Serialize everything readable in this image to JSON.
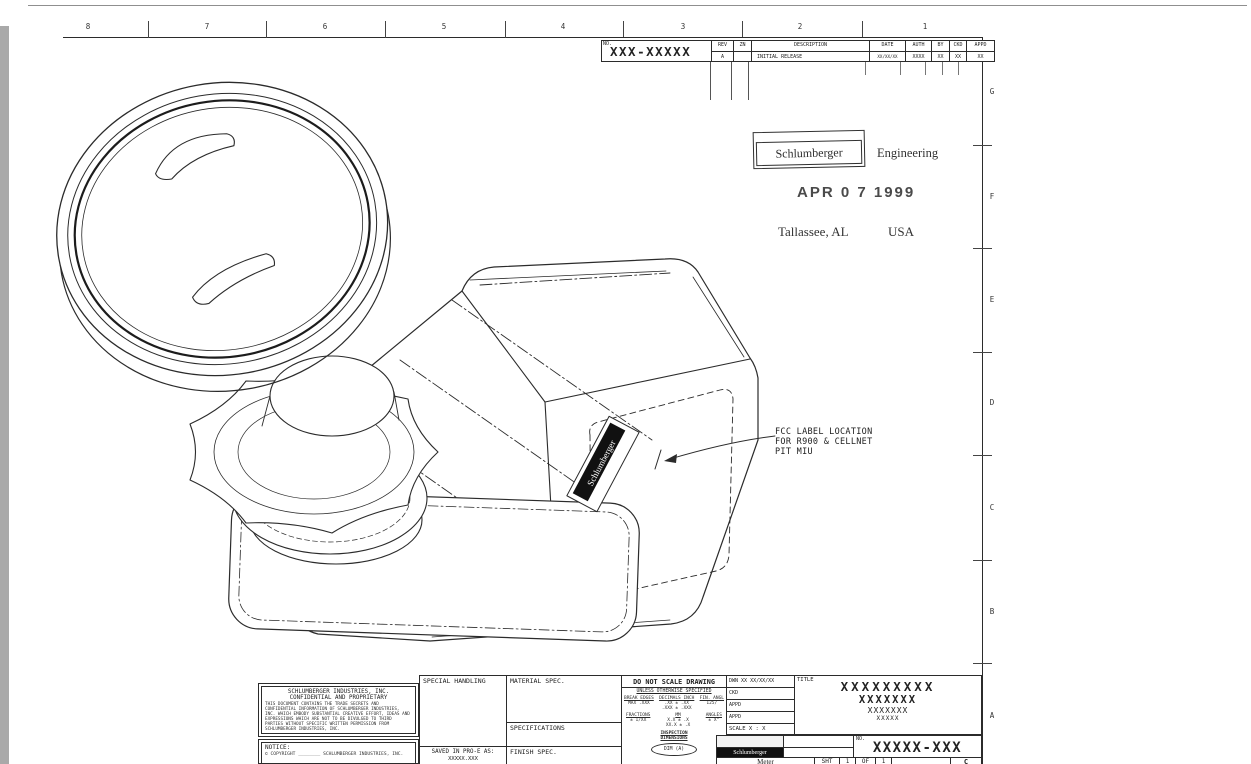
{
  "colors": {
    "ink": "#2b2b2b",
    "paper": "#ffffff",
    "scan_strip": "#a9a9a9",
    "label_bar": "#111111"
  },
  "zones": {
    "top": [
      "8",
      "7",
      "6",
      "5",
      "4",
      "3",
      "2",
      "1"
    ],
    "right": [
      "G",
      "F",
      "E",
      "D",
      "C",
      "B",
      "A"
    ]
  },
  "rev_table": {
    "no_label": "NO.",
    "number": "XXX-XXXXX",
    "col_rev": "REV",
    "col_zn": "ZN",
    "col_desc": "DESCRIPTION",
    "col_date": "DATE",
    "col_auth": "AUTH",
    "col_by": "BY",
    "col_ckd": "CKD",
    "col_appd": "APPD",
    "rev": "A",
    "zn": "",
    "desc": "INITIAL RELEASE",
    "date": "XX/XX/XX",
    "auth": "XXXX",
    "by": "XX",
    "ckd": "XX",
    "appd": "XX"
  },
  "stamp": {
    "logo": "Schlumberger",
    "org": "Engineering",
    "date": "APR 0 7 1999",
    "city": "Tallassee, AL",
    "country": "USA"
  },
  "fcc_note": {
    "line1": "FCC LABEL LOCATION",
    "line2": "FOR R900 & CELLNET",
    "line3": "PIT MIU"
  },
  "device": {
    "label": "Schlumberger"
  },
  "title_block": {
    "confidential": {
      "company": "SCHLUMBERGER INDUSTRIES, INC.",
      "subtitle": "CONFIDENTIAL AND PROPRIETARY",
      "body": "THIS DOCUMENT CONTAINS THE TRADE SECRETS AND CONFIDENTIAL INFORMATION OF SCHLUMBERGER INDUSTRIES, INC. WHICH EMBODY SUBSTANTIAL CREATIVE EFFORT, IDEAS AND EXPRESSIONS WHICH ARE NOT TO BE DIVULGED TO THIRD PARTIES WITHOUT SPECIFIC WRITTEN PERMISSION FROM SCHLUMBERGER INDUSTRIES, INC."
    },
    "notice": {
      "label": "NOTICE:",
      "copyright": "© COPYRIGHT ________  SCHLUMBERGER INDUSTRIES, INC."
    },
    "special_handling": "SPECIAL HANDLING",
    "saved_label": "SAVED IN PRO-E AS:",
    "saved_value": "XXXXX.XXX",
    "material": "MATERIAL SPEC.",
    "specifications": "SPECIFICATIONS",
    "finish": "FINISH SPEC.",
    "do_not_scale": "DO NOT SCALE DRAWING",
    "unless": "UNLESS OTHERWISE SPECIFIED",
    "tol": {
      "break1": "BREAK EDGES",
      "break2": "MAX .XXX",
      "dec_t": "DECIMALS INCH",
      "dec1": ".XX ± .XX",
      "dec2": ".XXX ± .XXX",
      "fin1": "FIN. ANGL",
      "fin2": "125/",
      "frac1": "FRACTIONS",
      "frac2": "± 1/XX",
      "mm_t": "MM",
      "mm1": "X.X ± .X",
      "mm2": "XX.X ± .X",
      "ang1": "ANGLES",
      "ang2": "± X°"
    },
    "inspection1": "INSPECTION",
    "inspection2": "DIMENSIONS",
    "dim_tag": "DIM (A)",
    "approvals": {
      "dwn": "DWN XX XX/XX/XX",
      "ckd": "CKD",
      "appd1": "APPD",
      "appd2": "APPD",
      "scale": "SCALE X : X"
    },
    "title_label": "TITLE",
    "title_lines": [
      "XXXXXXXXX",
      "XXXXXXX",
      "XXXXXXX",
      "XXXXX"
    ],
    "no_label": "NO.",
    "part_number": "XXXXX-XXX",
    "logo_bar": "Schlumberger",
    "product": "Meter",
    "sheet": {
      "sht": "SHT",
      "n1": "1",
      "of": "OF",
      "n2": "1",
      "size": "C"
    }
  }
}
